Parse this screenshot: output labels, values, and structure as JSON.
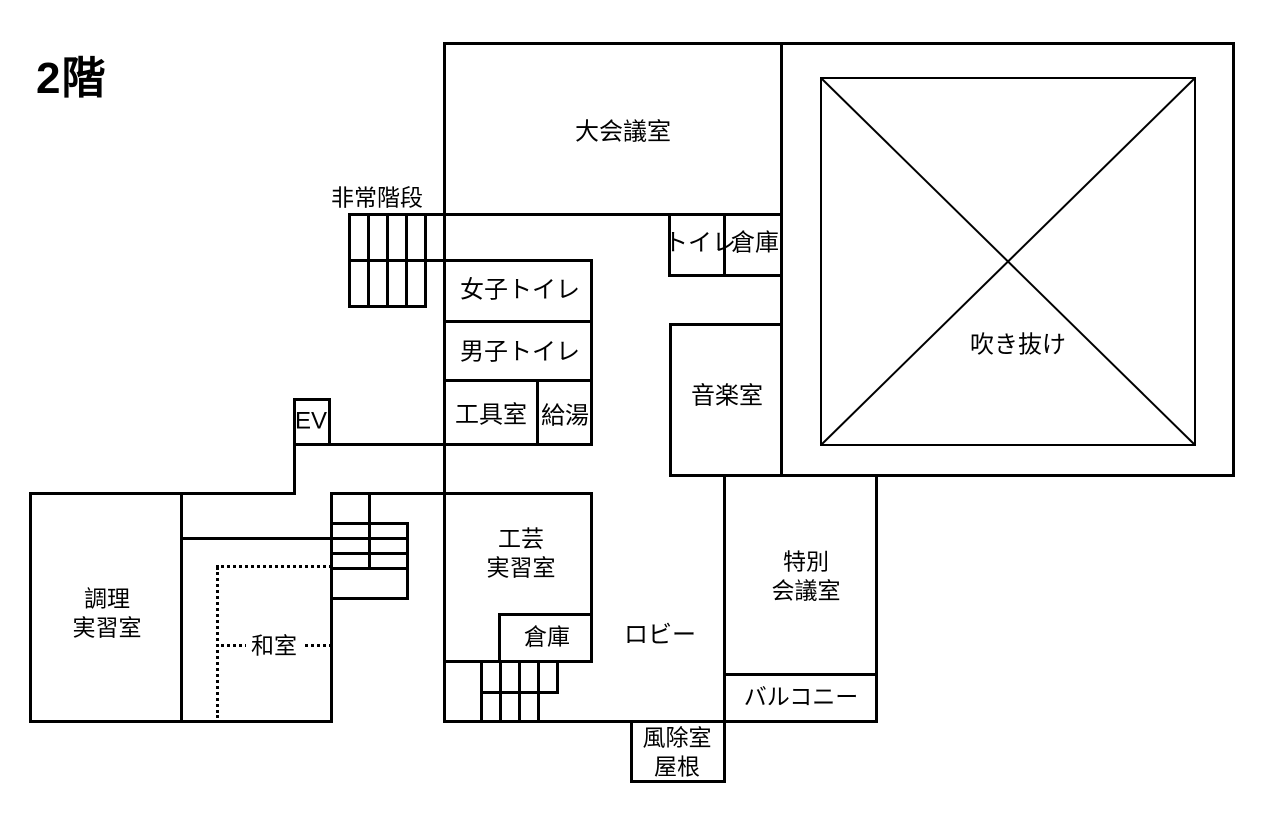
{
  "title": "2階",
  "colors": {
    "line": "#000000",
    "background": "#ffffff"
  },
  "canvas": {
    "width": 1270,
    "height": 814
  },
  "rooms": [
    {
      "id": "emergency-stairs",
      "lines": [
        "非常階段"
      ],
      "x": 377,
      "y": 198,
      "size": 23
    },
    {
      "id": "large-conference-room",
      "lines": [
        "大会議室"
      ],
      "x": 623,
      "y": 133,
      "size": 24
    },
    {
      "id": "toilet",
      "lines": [
        "トイレ"
      ],
      "x": 700,
      "y": 244,
      "size": 24
    },
    {
      "id": "storage-upper",
      "lines": [
        "倉庫"
      ],
      "x": 755,
      "y": 244,
      "size": 24
    },
    {
      "id": "atrium",
      "lines": [
        "吹き抜け"
      ],
      "x": 1018,
      "y": 346,
      "size": 24
    },
    {
      "id": "womens-toilet",
      "lines": [
        "女子トイレ"
      ],
      "x": 520,
      "y": 291,
      "size": 24
    },
    {
      "id": "mens-toilet",
      "lines": [
        "男子トイレ"
      ],
      "x": 520,
      "y": 353,
      "size": 24
    },
    {
      "id": "tool-room",
      "lines": [
        "工具室"
      ],
      "x": 491,
      "y": 416,
      "size": 24
    },
    {
      "id": "hot-water",
      "lines": [
        "給湯"
      ],
      "x": 565,
      "y": 417,
      "size": 24
    },
    {
      "id": "elevator",
      "lines": [
        "EV"
      ],
      "x": 311,
      "y": 422,
      "size": 24
    },
    {
      "id": "music-room",
      "lines": [
        "音楽室"
      ],
      "x": 727,
      "y": 397,
      "size": 24
    },
    {
      "id": "cooking-practice-room",
      "lines": [
        "調理",
        "実習室"
      ],
      "x": 107,
      "y": 614,
      "size": 23
    },
    {
      "id": "japanese-room",
      "lines": [
        "和室"
      ],
      "x": 274,
      "y": 646,
      "size": 23,
      "bg": true
    },
    {
      "id": "craft-practice-room",
      "lines": [
        "工芸",
        "実習室"
      ],
      "x": 521,
      "y": 554,
      "size": 23
    },
    {
      "id": "storage-lower",
      "lines": [
        "倉庫"
      ],
      "x": 547,
      "y": 637,
      "size": 23
    },
    {
      "id": "lobby",
      "lines": [
        "ロビー"
      ],
      "x": 660,
      "y": 636,
      "size": 24
    },
    {
      "id": "special-conference-room",
      "lines": [
        "特別",
        "会議室"
      ],
      "x": 806,
      "y": 577,
      "size": 23
    },
    {
      "id": "balcony",
      "lines": [
        "バルコニー"
      ],
      "x": 801,
      "y": 697,
      "size": 23
    },
    {
      "id": "windbreak-room-roof",
      "lines": [
        "風除室",
        "屋根"
      ],
      "x": 677,
      "y": 753,
      "size": 23
    }
  ],
  "walls": {
    "solid": [
      [
        443,
        42,
        790,
        3
      ],
      [
        348,
        213,
        434,
        3
      ],
      [
        348,
        259,
        245,
        3
      ],
      [
        348,
        305,
        79,
        3
      ],
      [
        668,
        274,
        115,
        3
      ],
      [
        443,
        320,
        150,
        3
      ],
      [
        443,
        379,
        150,
        3
      ],
      [
        293,
        443,
        300,
        3
      ],
      [
        293,
        398,
        38,
        3
      ],
      [
        29,
        492,
        265,
        3
      ],
      [
        330,
        492,
        263,
        3
      ],
      [
        180,
        537,
        228,
        3
      ],
      [
        330,
        522,
        78,
        3
      ],
      [
        330,
        552,
        78,
        3
      ],
      [
        330,
        567,
        78,
        3
      ],
      [
        330,
        597,
        78,
        3
      ],
      [
        29,
        720,
        304,
        3
      ],
      [
        498,
        613,
        95,
        3
      ],
      [
        443,
        660,
        150,
        3
      ],
      [
        480,
        691,
        78,
        3
      ],
      [
        443,
        720,
        435,
        3
      ],
      [
        630,
        780,
        95,
        3
      ],
      [
        669,
        323,
        114,
        3
      ],
      [
        669,
        474,
        566,
        3
      ],
      [
        723,
        673,
        155,
        3
      ],
      [
        443,
        42,
        3,
        681
      ],
      [
        780,
        42,
        3,
        435
      ],
      [
        1232,
        42,
        3,
        435
      ],
      [
        668,
        213,
        3,
        64
      ],
      [
        723,
        213,
        3,
        64
      ],
      [
        590,
        259,
        3,
        187
      ],
      [
        536,
        379,
        3,
        67
      ],
      [
        293,
        398,
        3,
        97
      ],
      [
        328,
        398,
        3,
        48
      ],
      [
        29,
        492,
        3,
        231
      ],
      [
        180,
        492,
        3,
        231
      ],
      [
        330,
        492,
        3,
        231
      ],
      [
        368,
        492,
        3,
        78
      ],
      [
        406,
        522,
        3,
        78
      ],
      [
        348,
        213,
        3,
        95
      ],
      [
        367,
        213,
        3,
        95
      ],
      [
        386,
        213,
        3,
        95
      ],
      [
        405,
        213,
        3,
        95
      ],
      [
        424,
        213,
        3,
        95
      ],
      [
        590,
        492,
        3,
        171
      ],
      [
        498,
        613,
        3,
        50
      ],
      [
        480,
        660,
        3,
        63
      ],
      [
        499,
        660,
        3,
        63
      ],
      [
        518,
        660,
        3,
        63
      ],
      [
        537,
        660,
        3,
        63
      ],
      [
        556,
        660,
        3,
        34
      ],
      [
        669,
        323,
        3,
        154
      ],
      [
        723,
        474,
        3,
        249
      ],
      [
        875,
        474,
        3,
        249
      ],
      [
        630,
        720,
        3,
        63
      ],
      [
        723,
        720,
        3,
        63
      ]
    ],
    "dotted_horizontal": [
      [
        216,
        565,
        116
      ],
      [
        216,
        644,
        116
      ]
    ],
    "dotted_vertical": [
      [
        216,
        567,
        151
      ]
    ]
  },
  "atrium_void": {
    "inner_square": {
      "x": 820,
      "y": 77,
      "w": 376,
      "h": 369
    },
    "border_px": 2,
    "has_diagonal_cross": true
  }
}
